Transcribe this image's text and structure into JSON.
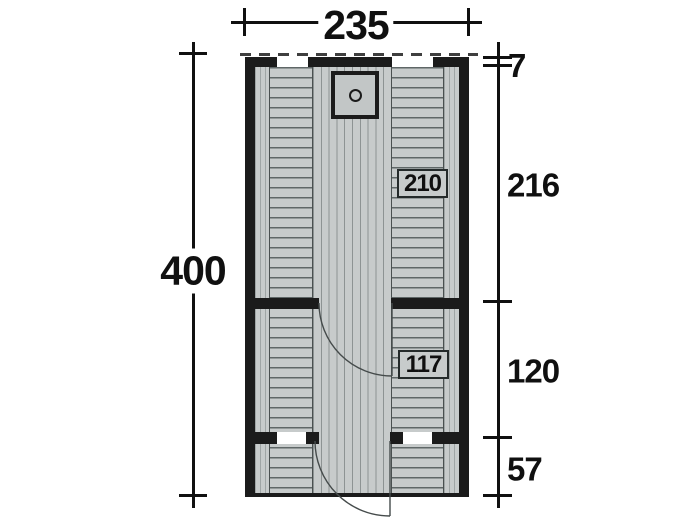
{
  "diagram": {
    "type": "floor-plan",
    "width": "235",
    "height": "400",
    "right": {
      "overhang": "7",
      "sauna_depth": "216",
      "room_depth": "120",
      "terrace_depth": "57"
    },
    "tags": {
      "sauna": "210",
      "room": "117"
    }
  },
  "colors": {
    "wall": "#1b1b1b",
    "floor": "#c7cbcb",
    "plank-line": "#8d9393",
    "slat-line": "#5f6767",
    "edge-line": "#9fa5a5",
    "door-arc": "#454b4b",
    "dim": "#101010",
    "dash": "#3f3f3f"
  }
}
